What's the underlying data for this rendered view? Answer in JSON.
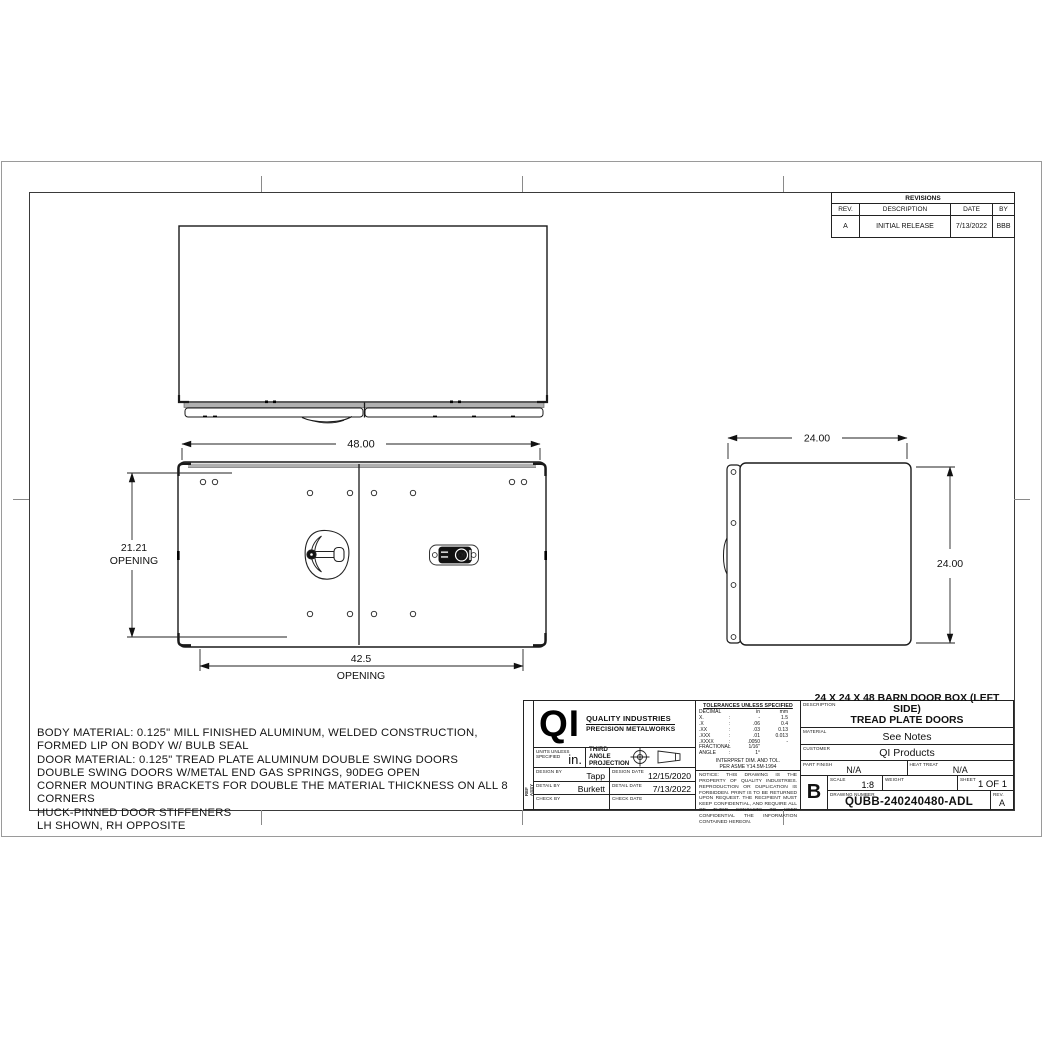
{
  "colors": {
    "line": "#1a1a1a",
    "shading": "#b0b0b0",
    "border_gray": "#9a9a9a"
  },
  "revisions": {
    "title": "REVISIONS",
    "headers": {
      "rev": "REV.",
      "description": "DESCRIPTION",
      "date": "DATE",
      "by": "BY"
    },
    "rows": [
      {
        "rev": "A",
        "description": "INITIAL RELEASE",
        "date": "7/13/2022",
        "by": "BBB"
      }
    ]
  },
  "dimensions": {
    "front_width": "48.00",
    "opening_height": "21.21",
    "opening_height_label": "OPENING",
    "opening_width": "42.5",
    "opening_width_label": "OPENING",
    "side_width": "24.00",
    "side_height": "24.00"
  },
  "latch": {
    "logo": "QI"
  },
  "notes": {
    "lines": [
      "BODY MATERIAL: 0.125\" MILL FINISHED ALUMINUM, WELDED CONSTRUCTION,",
      "FORMED LIP ON BODY W/ BULB SEAL",
      "DOOR MATERIAL: 0.125\" TREAD PLATE ALUMINUM DOUBLE SWING DOORS",
      "DOUBLE SWING DOORS W/METAL END GAS SPRINGS, 90DEG OPEN",
      "CORNER MOUNTING BRACKETS FOR DOUBLE THE MATERIAL THICKNESS ON ALL 8 CORNERS",
      "HUCK-PINNED DOOR STIFFENERS",
      "LH SHOWN, RH OPPOSITE"
    ]
  },
  "title_block": {
    "ref_line1": "REF",
    "ref_line2": "ASSY",
    "logo": {
      "mark": "QI",
      "line1": "QUALITY INDUSTRIES",
      "line2": "PRECISION METALWORKS"
    },
    "units": {
      "label": "UNITS UNLESS SPECIFIED",
      "value": "in."
    },
    "projection": {
      "label": "THIRD ANGLE PROJECTION"
    },
    "people": {
      "design_by_label": "DESIGN BY",
      "design_by": "Tapp",
      "design_date_label": "DESIGN DATE",
      "design_date": "12/15/2020",
      "detail_by_label": "DETAIL BY",
      "detail_by": "Burkett",
      "detail_date_label": "DETAIL DATE",
      "detail_date": "7/13/2022",
      "check_by_label": "CHECK BY",
      "check_by": "",
      "check_date_label": "CHECK DATE",
      "check_date": ""
    },
    "tolerances": {
      "title": "TOLERANCES UNLESS SPECIFIED",
      "decimal_label": "DECIMAL",
      "col_in": "in",
      "col_mm": "mm",
      "sep": ":",
      "rows": [
        {
          "label": "X.",
          "in": "-",
          "mm": "1.5"
        },
        {
          "label": ".X",
          "in": ".06",
          "mm": "0.4"
        },
        {
          "label": ".XX",
          "in": ".03",
          "mm": "0.13"
        },
        {
          "label": ".XXX",
          "in": ".01",
          "mm": "0.013"
        },
        {
          "label": ".XXXX",
          "in": ".0050",
          "mm": "-"
        },
        {
          "label": "FRACTIONAL",
          "in": "1/16\"",
          "mm": ""
        },
        {
          "label": "ANGLE",
          "in": "1°",
          "mm": ""
        }
      ]
    },
    "interpret_line1": "INTERPRET DIM. AND TOL.",
    "interpret_line2": "PER ASME Y14.5M-1994",
    "notice": "NOTICE:  THIS DRAWING IS THE PROPERTY OF QUALITY INDUSTRIES.    REPRODUCTION OR DUPLICATION IS FORBIDDEN.  PRINT IS TO BE RETURNED UPON REQUEST.  THE RECIPIENT MUST KEEP CONFIDENTIAL, AND REQUIRE ALL OF THEIR CONTACTS TO KEEP CONFIDENTIAL THE INFORMATION CONTAINED HEREON.",
    "description": {
      "label": "DESCRIPTION",
      "line1": "24 X 24 X 48 BARN DOOR BOX (LEFT SIDE)",
      "line2": "TREAD PLATE DOORS"
    },
    "material": {
      "label": "MATERIAL",
      "value": "See Notes"
    },
    "customer": {
      "label": "CUSTOMER",
      "value": "QI Products"
    },
    "part_finish": {
      "label": "PART FINISH",
      "value": "N/A"
    },
    "heat_treat": {
      "label": "HEAT TREAT",
      "value": "N/A"
    },
    "size": "B",
    "scale": {
      "label": "SCALE",
      "value": "1:8"
    },
    "weight": {
      "label": "WEIGHT",
      "value": ""
    },
    "sheet": {
      "label": "SHEET",
      "value": "1 OF 1"
    },
    "drawing_number": {
      "label": "DRAWING NUMBER",
      "value": "QUBB-240240480-ADL"
    },
    "rev": {
      "label": "REV.",
      "value": "A"
    }
  }
}
